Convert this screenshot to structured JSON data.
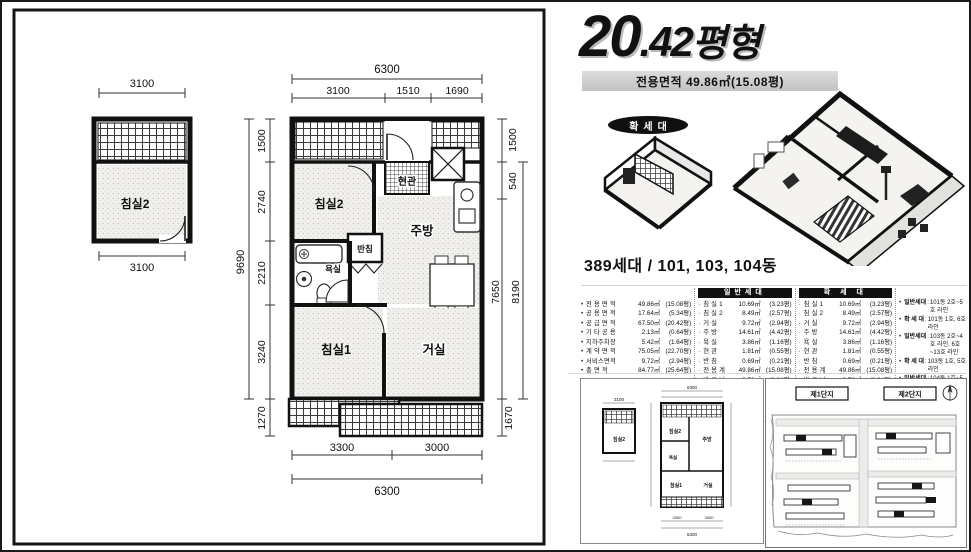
{
  "header": {
    "title_number": "20",
    "title_decimal": ".42",
    "title_suffix": "평형",
    "subtitle": "전용면적 49.86㎡(15.08평)"
  },
  "iso": {
    "badge": "확세대"
  },
  "units_heading": "389세대 / 101, 103, 104동",
  "left_plan": {
    "small": {
      "room": "침실2",
      "dim_top": "3100",
      "dim_bottom": "3100"
    },
    "column": {
      "total": "9690",
      "segments": [
        "1500",
        "2740",
        "2210",
        "3240",
        "1270"
      ]
    },
    "main": {
      "dim_top_total": "6300",
      "dims_top": [
        "3100",
        "1510",
        "1690"
      ],
      "dims_right": {
        "top": "1500",
        "small": "540",
        "inner_total": "7650",
        "outer_total": "8190",
        "bottom": "1670"
      },
      "dims_bottom": [
        "3300",
        "3000"
      ],
      "dim_bottom_total": "6300",
      "rooms": {
        "bedroom2": "침실2",
        "entrance": "현관",
        "kitchen": "주방",
        "closet": "반침",
        "bath": "욕실",
        "bedroom1": "침실1",
        "living": "거실"
      }
    }
  },
  "table": {
    "summary": [
      {
        "label": "전 용 면 적",
        "value": "49.86㎡",
        "py": "(15.08평)"
      },
      {
        "label": "공 용 면 적",
        "value": "17.64㎡",
        "py": "(5.34평)"
      },
      {
        "label": "공 급 면 적",
        "value": "67.50㎡",
        "py": "(20.42평)"
      },
      {
        "label": "기 타 공 용",
        "value": "2.13㎡",
        "py": "(0.64평)"
      },
      {
        "label": "지하주차장",
        "value": "5.42㎡",
        "py": "(1.64평)"
      },
      {
        "label": "계 약 면 적",
        "value": "75.05㎡",
        "py": "(22.70평)"
      },
      {
        "label": "서비스면적",
        "value": "9.72㎡",
        "py": "(2.94평)"
      },
      {
        "label": "총  면  적",
        "value": "84.77㎡",
        "py": "(25.64평)"
      }
    ],
    "general": {
      "header": "일반세대",
      "rows": [
        {
          "label": "침 실 1",
          "value": "10.69㎡",
          "py": "(3.23평)"
        },
        {
          "label": "침 실 2",
          "value": "8.49㎡",
          "py": "(2.57평)"
        },
        {
          "label": "거    실",
          "value": "9.72㎡",
          "py": "(2.94평)"
        },
        {
          "label": "주    방",
          "value": "14.61㎡",
          "py": "(4.42평)"
        },
        {
          "label": "욕    실",
          "value": "3.86㎡",
          "py": "(1.16평)"
        },
        {
          "label": "현    관",
          "value": "1.81㎡",
          "py": "(0.55평)"
        },
        {
          "label": "반    침",
          "value": "0.69㎡",
          "py": "(0.21평)"
        },
        {
          "label": "전 용 계",
          "value": "49.86㎡",
          "py": "(15.08평)"
        },
        {
          "label": "발 코 니",
          "value": "9.72㎡",
          "py": "(2.94평)"
        }
      ]
    },
    "expanded": {
      "header": "확 세 대",
      "rows": [
        {
          "label": "침 실 1",
          "value": "10.69㎡",
          "py": "(3.23평)"
        },
        {
          "label": "침 실 2",
          "value": "8.49㎡",
          "py": "(2.57평)"
        },
        {
          "label": "거    실",
          "value": "9.72㎡",
          "py": "(2.94평)"
        },
        {
          "label": "주    방",
          "value": "14.61㎡",
          "py": "(4.42평)"
        },
        {
          "label": "욕    실",
          "value": "3.86㎡",
          "py": "(1.16평)"
        },
        {
          "label": "현    관",
          "value": "1.81㎡",
          "py": "(0.55평)"
        },
        {
          "label": "반    침",
          "value": "0.69㎡",
          "py": "(0.21평)"
        },
        {
          "label": "전 용 계",
          "value": "49.86㎡",
          "py": "(15.08평)"
        },
        {
          "label": "발 코 니",
          "value": "9.72㎡",
          "py": "(2.94평)"
        },
        {
          "label": "확    장",
          "value": "4.65㎡",
          "py": "(1.41평)"
        }
      ]
    },
    "legend": [
      {
        "label": "일반세대",
        "value": "101동 2호~5호 라인"
      },
      {
        "label": "확 세 대",
        "value": "101동 1호, 6호 라인"
      },
      {
        "label": "일반세대",
        "value": "103동 2호~4호 라인, 6호~13호 라인"
      },
      {
        "label": "확 세 대",
        "value": "103동 1호, 5호 라인"
      },
      {
        "label": "일반세대",
        "value": "104동 1호~5호 라인, 7호~9호 라인"
      },
      {
        "label": "확 세 대",
        "value": "104동 6호, 10호 라인"
      }
    ]
  },
  "panels": {
    "site": {
      "label_left": "제1단지",
      "label_right": "제2단지"
    }
  }
}
